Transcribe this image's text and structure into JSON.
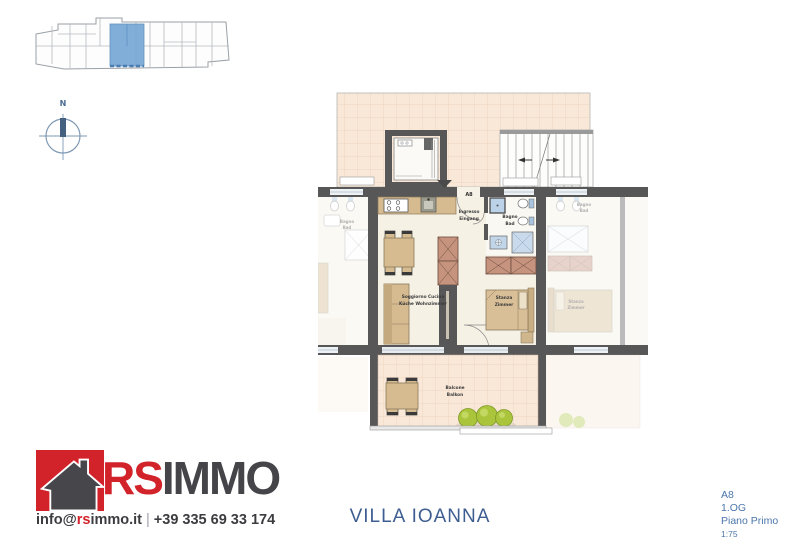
{
  "compass": {
    "north": "N"
  },
  "floor_plan": {
    "unit_label": "A8",
    "rooms": {
      "entrance": {
        "line1": "Ingresso",
        "line2": "Eingang"
      },
      "bath": {
        "line1": "Bagno",
        "line2": "Bad"
      },
      "living": {
        "line1": "Soggiorno Cucina",
        "line2": "Küche Wohnzimmer"
      },
      "bedroom": {
        "line1": "Stanza",
        "line2": "Zimmer"
      },
      "balcony": {
        "line1": "Balcone",
        "line2": "Balkon"
      }
    },
    "neighbors": {
      "left_bath": {
        "line1": "Bagno",
        "line2": "Bad"
      },
      "right_bath": {
        "line1": "Bagno",
        "line2": "Bad"
      },
      "right_bedroom": {
        "line1": "Stanza",
        "line2": "Zimmer"
      }
    }
  },
  "footer": {
    "brand": {
      "red_part": "RS",
      "dark_part": "IMMO"
    },
    "contact": {
      "email_prefix": "info@",
      "email_highlight": "rs",
      "email_suffix": "immo.it",
      "separator": "|",
      "phone": "+39 335 69 33 174"
    },
    "project_name": "VILLA IOANNA",
    "unit_info": {
      "unit": "A8",
      "floor_de": "1.OG",
      "floor_it": "Piano Primo",
      "scale": "1:75"
    }
  },
  "colors": {
    "brand_red": "#d2232a",
    "brand_gray": "#454549",
    "accent_blue": "#3e5e92",
    "highlight_unit_blue": "#74a5d6",
    "terrace_peach": "#f9e8d8",
    "wall_gray": "#575757",
    "furniture_tan": "#d6ba90",
    "wardrobe_brown": "#c5937e",
    "fixture_blue": "#bcd2e8",
    "plant_green": "#aac53c"
  }
}
